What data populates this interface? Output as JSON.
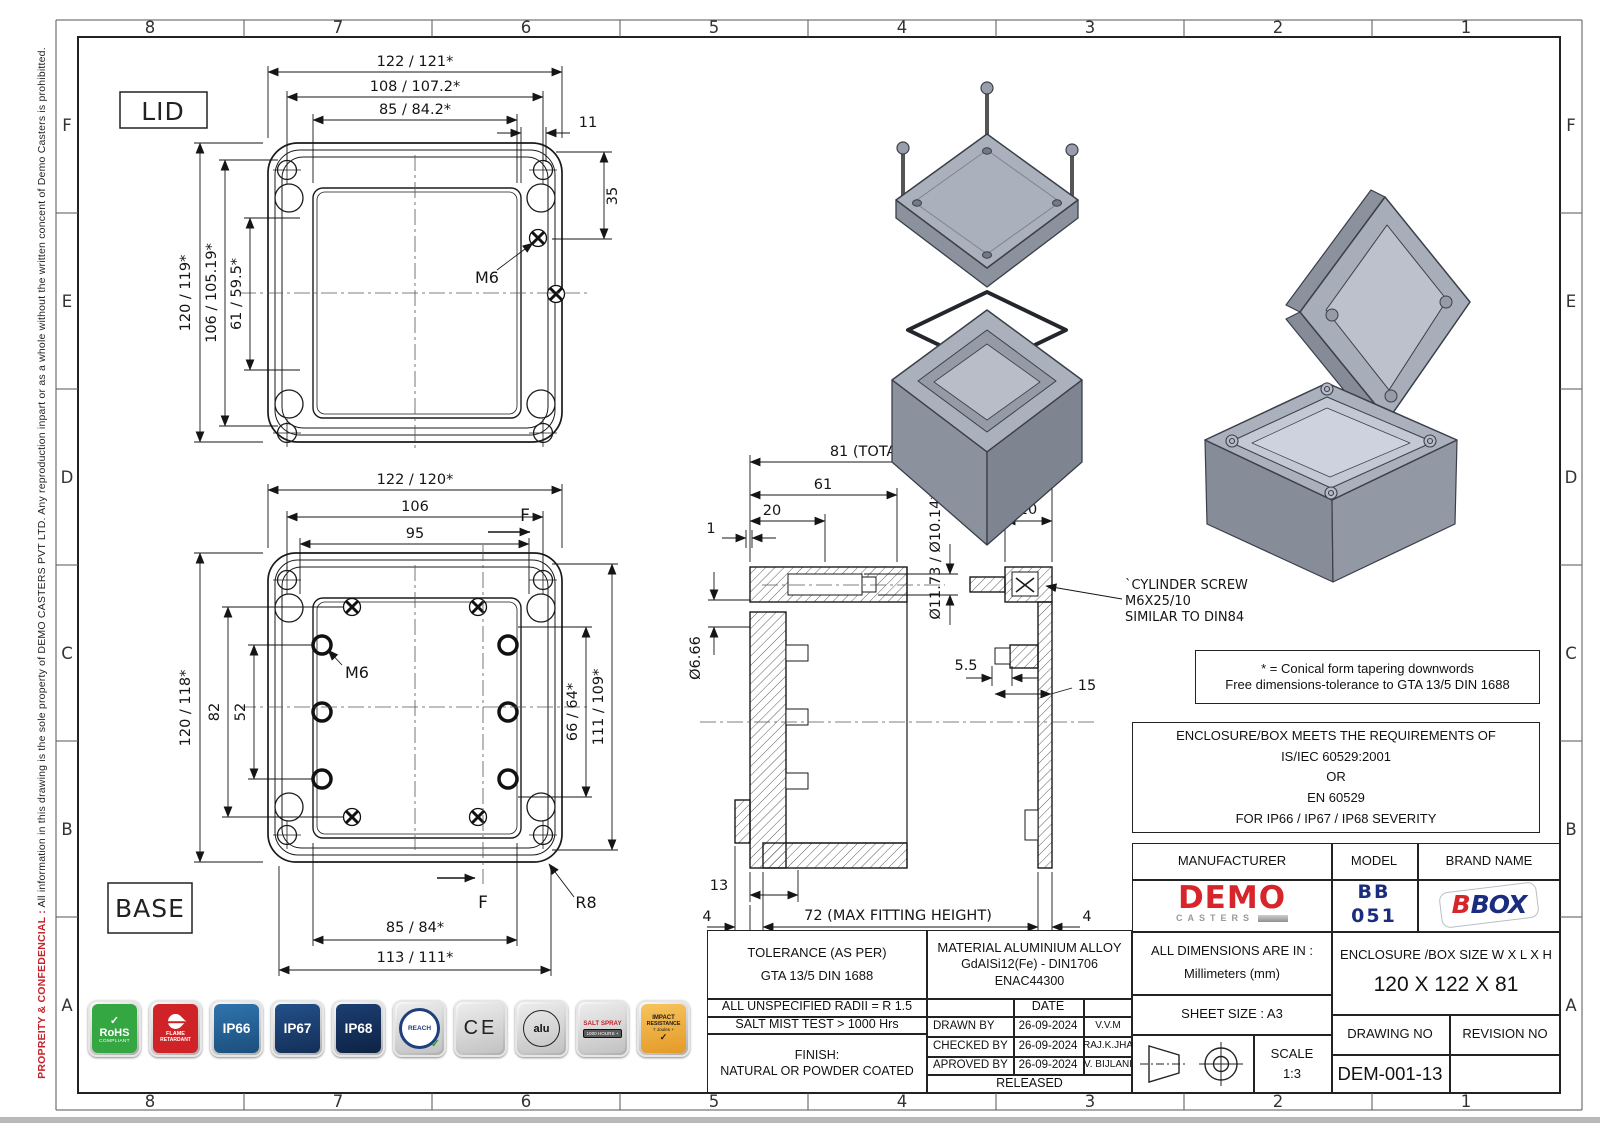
{
  "frame": {
    "cols": [
      "8",
      "7",
      "6",
      "5",
      "4",
      "3",
      "2",
      "1"
    ],
    "rows": [
      "F",
      "E",
      "D",
      "C",
      "B",
      "A"
    ],
    "confidential_red": "PROPREITY & CONFEDENCIAL :",
    "confidential_rest": "  All information in this drawing is the sole property of DEMO CASTERS PVT LTD.  Any reproduction inpart or as a whole without the written concent of Demo Casters is prohibitted."
  },
  "views": {
    "lid_label": "LID",
    "base_label": "BASE",
    "lid": {
      "w1": "122 / 121*",
      "w2": "108 / 107.2*",
      "w3": "85 / 84.2*",
      "corner": "11",
      "corner_v": "35",
      "h1": "120 / 119*",
      "h2": "106 / 105.19*",
      "h3": "61 / 59.5*",
      "screw": "M6"
    },
    "base": {
      "w1": "122 / 120*",
      "w2": "106",
      "w3": "95",
      "h1": "120 / 118*",
      "h2": "82",
      "h3": "52",
      "r1": "66 / 64*",
      "r2": "111 / 109*",
      "b1": "85 / 84*",
      "b2": "113 / 111*",
      "screw": "M6",
      "radius": "R8",
      "section": "F"
    },
    "section": {
      "total": "81 (TOTAL HEIGHT)",
      "d61": "61",
      "d20l": "20",
      "d1": "1",
      "dia1": "Ø11.73 / Ø10.14*",
      "dia2": "Ø6.66",
      "d20r": "20",
      "d55": "5.5",
      "d15": "15",
      "d13": "13",
      "d4l": "4",
      "d4r": "4",
      "maxfit": "72 (MAX FITTING HEIGHT)",
      "note1": "`CYLINDER SCREW",
      "note2": "M6X25/10",
      "note3": "SIMILAR TO DIN84"
    }
  },
  "notes": {
    "conical1": "* = Conical form tapering downwords",
    "conical2": "Free dimensions-tolerance to GTA 13/5 DIN 1688",
    "req1": "ENCLOSURE/BOX MEETS THE REQUIREMENTS OF",
    "req2": "IS/IEC 60529:2001",
    "req3": "OR",
    "req4": "EN 60529",
    "req5": "FOR IP66 / IP67 / IP68 SEVERITY"
  },
  "tol": {
    "header1": "TOLERANCE (AS PER)",
    "header2": "GTA 13/5 DIN 1688",
    "radii": "ALL UNSPECIFIED RADII = R 1.5",
    "salt": "SALT MIST TEST > 1000 Hrs",
    "finish1": "FINISH:",
    "finish2": "NATURAL OR POWDER COATED",
    "material1": "MATERIAL ALUMINIUM ALLOY",
    "material2": "GdAISi12(Fe) - DIN1706",
    "material3": "ENAC44300",
    "date_header": "DATE",
    "rows": [
      {
        "role": "DRAWN BY",
        "date": "26-09-2024",
        "name": "V.V.M"
      },
      {
        "role": "CHECKED BY",
        "date": "26-09-2024",
        "name": "RAJ.K.JHA"
      },
      {
        "role": "APROVED BY",
        "date": "26-09-2024",
        "name": "V. BIJLANI"
      }
    ],
    "released": "RELEASED"
  },
  "title": {
    "manufacturer_h": "MANUFACTURER",
    "model_h": "MODEL",
    "brand_h": "BRAND NAME",
    "demo": "DEMO",
    "demo_sub": "CASTERS",
    "model_value": "BB 051",
    "brand_b": "B",
    "brand_box": "BOX",
    "dims1": "ALL DIMENSIONS ARE IN :",
    "dims2": "Millimeters (mm)",
    "sheet": "SHEET SIZE : A3",
    "scale_label": "SCALE",
    "scale_value": "1:3",
    "size_header": "ENCLOSURE /BOX SIZE W X L X H",
    "size_value": "120 X 122 X 81",
    "drawing_no_h": "DRAWING NO",
    "revision_h": "REVISION NO",
    "drawing_no": "DEM-001-13",
    "revision_no": ""
  },
  "badges": [
    {
      "name": "rohs-compliant",
      "bg": "#35a742",
      "mark": "✓",
      "line1": "RoHS",
      "line2": "COMPLIANT"
    },
    {
      "name": "flame-retardant",
      "bg": "#d02327",
      "line1": "FLAME",
      "line2": "RETARDANT"
    },
    {
      "name": "ip66",
      "bg": "#27659b",
      "label": "IP66"
    },
    {
      "name": "ip67",
      "bg": "#1a4579",
      "label": "IP67"
    },
    {
      "name": "ip68",
      "bg": "#143463",
      "label": "IP68"
    },
    {
      "name": "reach",
      "label": "REACH",
      "mark": "✓"
    },
    {
      "name": "ce",
      "label": "CE"
    },
    {
      "name": "alu-recyclable",
      "label": "alu"
    },
    {
      "name": "salt-spray",
      "line1": "SALT SPRAY",
      "line2": "1000 HOURS +"
    },
    {
      "name": "impact-resistance",
      "bg": "#efac3a",
      "line1": "IMPACT",
      "line2": "RESISTANCE",
      "line3": "7 Joules +",
      "mark": "✓"
    }
  ],
  "colors": {
    "accent_red": "#d6252b",
    "navy": "#1b2d7e",
    "line": "#1a1a1a",
    "metal_gray": "#a9aebb",
    "green": "#35a742"
  }
}
